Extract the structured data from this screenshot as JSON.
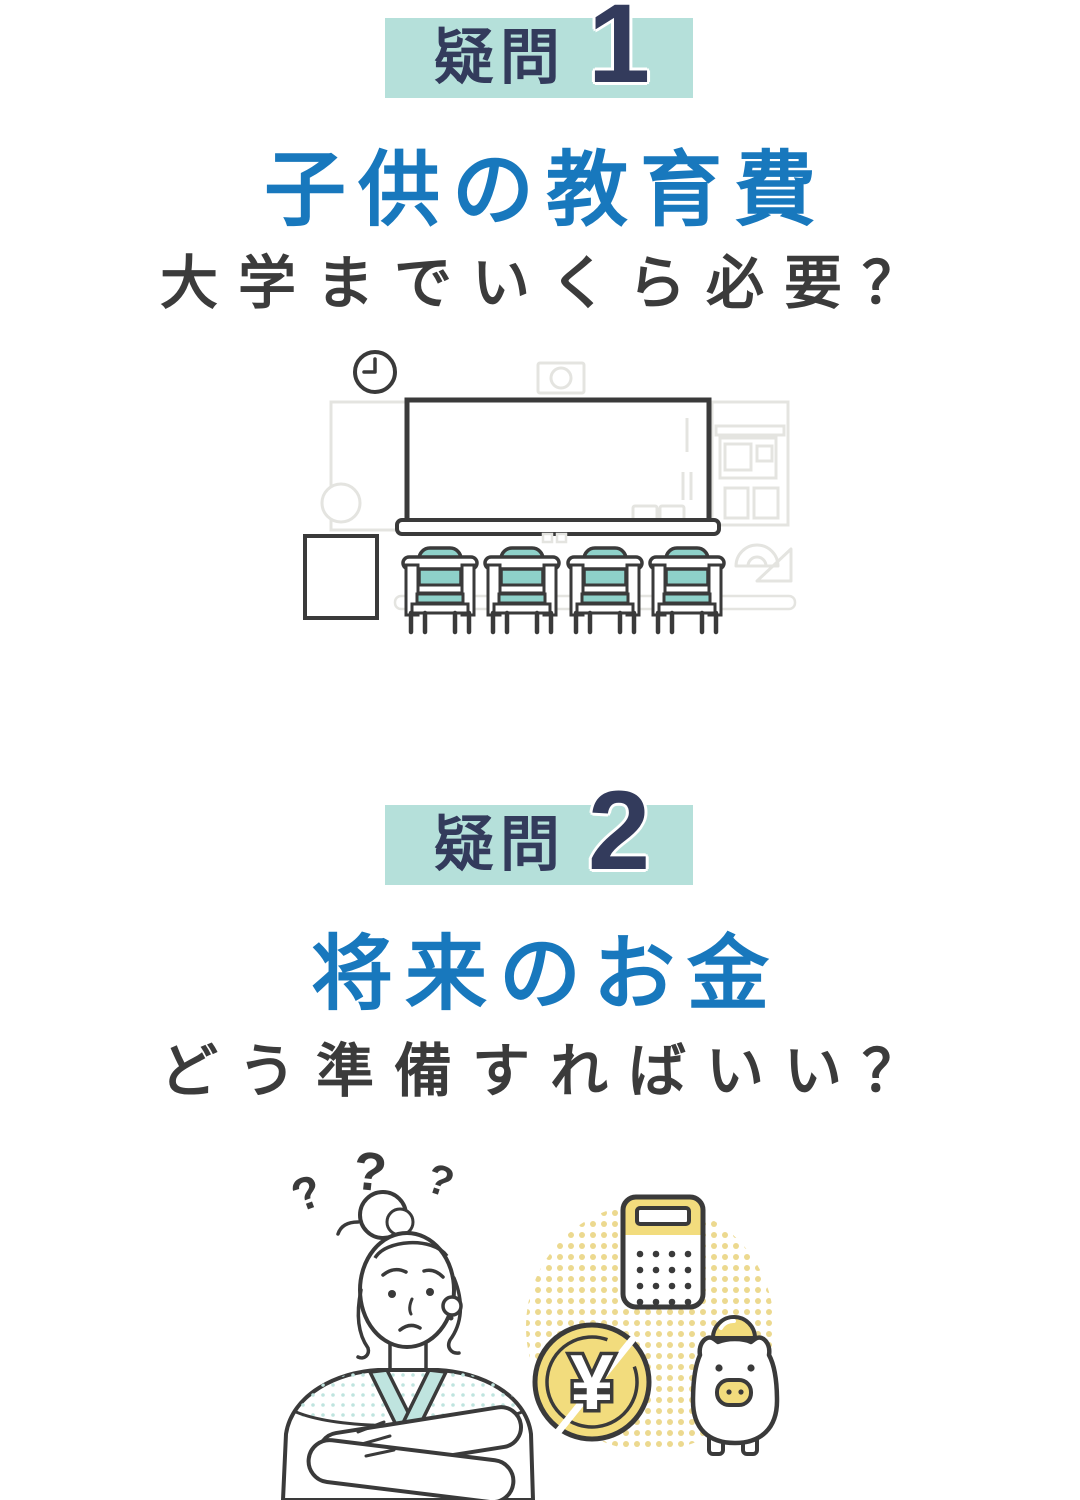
{
  "colors": {
    "bg": "#ffffff",
    "badge_bg": "#b5e0da",
    "badge_text": "#333b5c",
    "title_blue": "#1878bd",
    "subtitle_dark": "#3b3b3b",
    "outline_dark": "#3a3a3a",
    "outline_light": "#e4e4e0",
    "teal": "#8ed1c9",
    "teal_light": "#bfe4df",
    "yellow": "#f2dc7d",
    "dot_yellow": "#ecd98f"
  },
  "sections": [
    {
      "badge_label": "疑問",
      "badge_number": "1",
      "title": "子供の教育費",
      "subtitle": "大学までいくら必要？"
    },
    {
      "badge_label": "疑問",
      "badge_number": "2",
      "title": "将来のお金",
      "subtitle": "どう準備すればいい？"
    }
  ],
  "illustrations": {
    "question_mark": "?",
    "yen_symbol": "¥"
  }
}
